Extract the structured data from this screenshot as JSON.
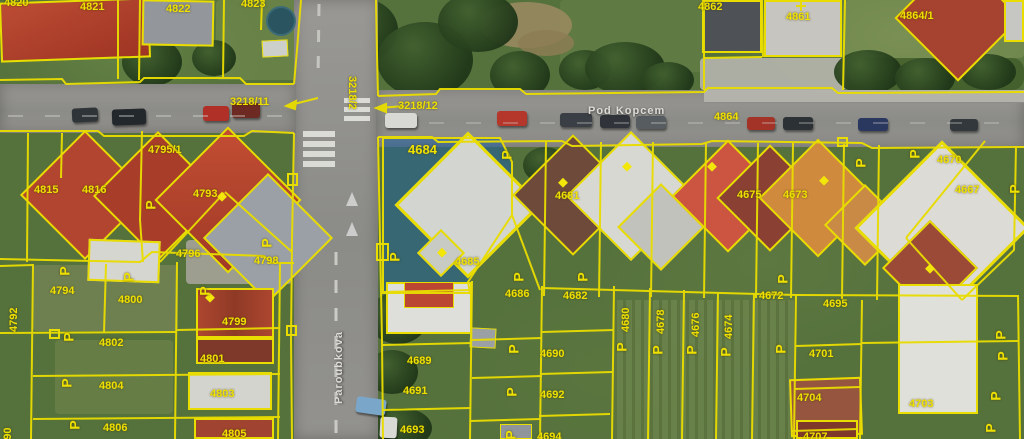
{
  "map": {
    "colors": {
      "parcel_line": "#e8dc00",
      "parcel_label": "#eee000",
      "selection_fill": "#1e5f9e",
      "road_surface": "#8e8e8a",
      "street_label": "#dddcd6"
    },
    "symbol_glyph": "P",
    "selected_parcels": [
      "4684",
      "4685"
    ],
    "streets": [
      {
        "name": "Pod Kopcem",
        "x": 588,
        "y": 105,
        "rot": 0
      },
      {
        "name": "Paroubkova",
        "x": 333,
        "y": 404,
        "rot": -90
      }
    ],
    "road_parcels": [
      {
        "text": "3218/11",
        "x": 230,
        "y": 96
      },
      {
        "text": "3218/12",
        "x": 398,
        "y": 100
      },
      {
        "text": "3218/2",
        "x": 358,
        "y": 76,
        "rot": 90
      },
      {
        "text": "4864",
        "x": 714,
        "y": 111
      }
    ],
    "parcel_labels": [
      {
        "text": "4820",
        "x": 4,
        "y": -3
      },
      {
        "text": "4821",
        "x": 80,
        "y": 1
      },
      {
        "text": "4822",
        "x": 166,
        "y": 3
      },
      {
        "text": "4823",
        "x": 241,
        "y": -2
      },
      {
        "text": "4862",
        "x": 698,
        "y": 1
      },
      {
        "text": "4861",
        "x": 786,
        "y": 11
      },
      {
        "text": "4864/1",
        "x": 900,
        "y": 10
      },
      {
        "text": "4795/1",
        "x": 148,
        "y": 144
      },
      {
        "text": "4815",
        "x": 34,
        "y": 184
      },
      {
        "text": "4816",
        "x": 82,
        "y": 184
      },
      {
        "text": "4793",
        "x": 193,
        "y": 188
      },
      {
        "text": "4796",
        "x": 176,
        "y": 248
      },
      {
        "text": "4798",
        "x": 254,
        "y": 255
      },
      {
        "text": "4792",
        "x": 8,
        "y": 332,
        "rot": -90
      },
      {
        "text": "4790",
        "x": 2,
        "y": 452,
        "rot": -90
      },
      {
        "text": "4794",
        "x": 50,
        "y": 285
      },
      {
        "text": "4800",
        "x": 118,
        "y": 294
      },
      {
        "text": "4802",
        "x": 99,
        "y": 337
      },
      {
        "text": "4804",
        "x": 99,
        "y": 380
      },
      {
        "text": "4806",
        "x": 103,
        "y": 422
      },
      {
        "text": "4799",
        "x": 222,
        "y": 316
      },
      {
        "text": "4801",
        "x": 200,
        "y": 353
      },
      {
        "text": "4803",
        "x": 210,
        "y": 388
      },
      {
        "text": "4805",
        "x": 222,
        "y": 428
      },
      {
        "text": "4684",
        "x": 408,
        "y": 144,
        "size": 13
      },
      {
        "text": "4685",
        "x": 455,
        "y": 256
      },
      {
        "text": "4681",
        "x": 555,
        "y": 190
      },
      {
        "text": "4675",
        "x": 737,
        "y": 189
      },
      {
        "text": "4673",
        "x": 783,
        "y": 189
      },
      {
        "text": "4670",
        "x": 937,
        "y": 154
      },
      {
        "text": "4667",
        "x": 955,
        "y": 184
      },
      {
        "text": "4686",
        "x": 505,
        "y": 288
      },
      {
        "text": "4682",
        "x": 563,
        "y": 290
      },
      {
        "text": "4680",
        "x": 620,
        "y": 332,
        "rot": -90
      },
      {
        "text": "4678",
        "x": 655,
        "y": 334,
        "rot": -90
      },
      {
        "text": "4676",
        "x": 690,
        "y": 337,
        "rot": -90
      },
      {
        "text": "4674",
        "x": 723,
        "y": 339,
        "rot": -90
      },
      {
        "text": "4672",
        "x": 759,
        "y": 290
      },
      {
        "text": "4695",
        "x": 823,
        "y": 298
      },
      {
        "text": "4701",
        "x": 809,
        "y": 348
      },
      {
        "text": "4704",
        "x": 797,
        "y": 392
      },
      {
        "text": "4707",
        "x": 803,
        "y": 431
      },
      {
        "text": "4703",
        "x": 909,
        "y": 398
      },
      {
        "text": "4689",
        "x": 407,
        "y": 355
      },
      {
        "text": "4691",
        "x": 403,
        "y": 385
      },
      {
        "text": "4693",
        "x": 400,
        "y": 424
      },
      {
        "text": "4690",
        "x": 540,
        "y": 348
      },
      {
        "text": "4692",
        "x": 540,
        "y": 389
      },
      {
        "text": "4694",
        "x": 537,
        "y": 431
      }
    ],
    "symbols": [
      {
        "x": 60,
        "y": 264
      },
      {
        "x": 124,
        "y": 270
      },
      {
        "x": 146,
        "y": 198
      },
      {
        "x": 262,
        "y": 236
      },
      {
        "x": 390,
        "y": 250
      },
      {
        "x": 502,
        "y": 148
      },
      {
        "x": 514,
        "y": 270
      },
      {
        "x": 200,
        "y": 284
      },
      {
        "x": 64,
        "y": 330
      },
      {
        "x": 62,
        "y": 376
      },
      {
        "x": 70,
        "y": 418
      },
      {
        "x": 509,
        "y": 342
      },
      {
        "x": 507,
        "y": 385
      },
      {
        "x": 506,
        "y": 428
      },
      {
        "x": 617,
        "y": 340
      },
      {
        "x": 653,
        "y": 343
      },
      {
        "x": 687,
        "y": 343
      },
      {
        "x": 721,
        "y": 345
      },
      {
        "x": 776,
        "y": 342
      },
      {
        "x": 578,
        "y": 270
      },
      {
        "x": 910,
        "y": 147
      },
      {
        "x": 856,
        "y": 156
      },
      {
        "x": 996,
        "y": 328
      },
      {
        "x": 998,
        "y": 349
      },
      {
        "x": 991,
        "y": 389
      },
      {
        "x": 986,
        "y": 421
      },
      {
        "x": 1010,
        "y": 182
      },
      {
        "x": 778,
        "y": 272
      }
    ]
  }
}
